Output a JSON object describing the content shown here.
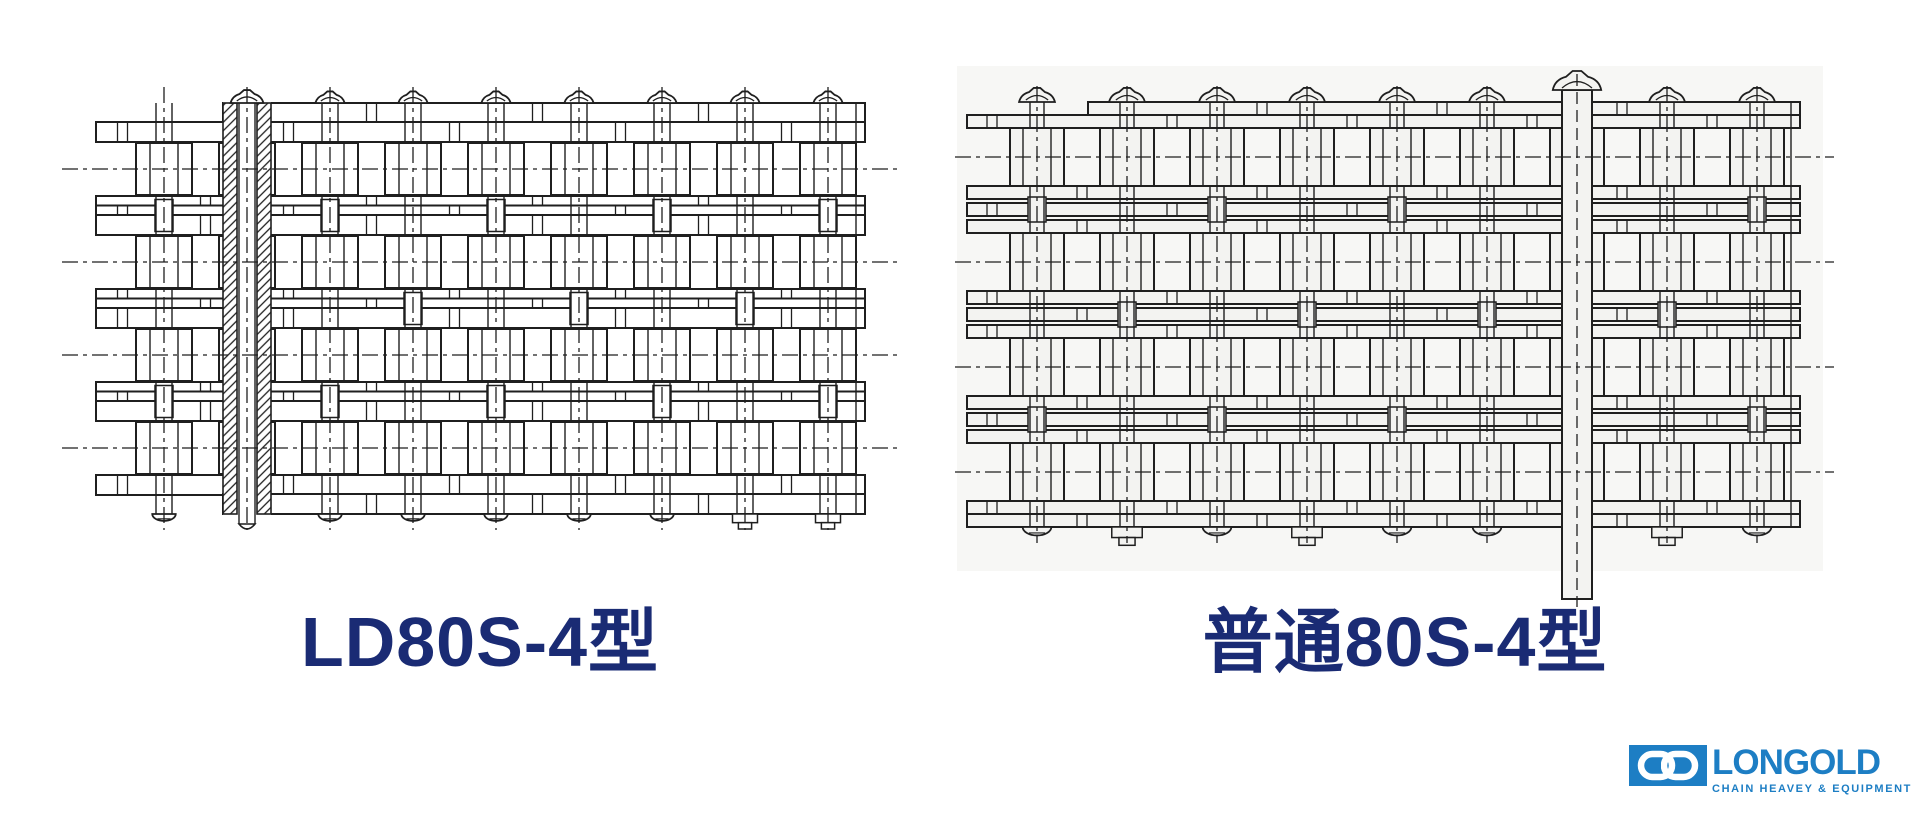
{
  "page": {
    "background_color": "#ffffff"
  },
  "drawings": {
    "left": {
      "label": "LD80S-4型"
    },
    "right": {
      "label": "普通80S-4型"
    }
  },
  "style": {
    "label_color": "#1a2b74",
    "line_color": "#1f1f1f",
    "right_drawing_fill": "#f3f3f1",
    "right_drawing_backdrop": "#f7f7f5",
    "logo_color": "#1d7ec4"
  },
  "logo": {
    "brand": "LONGOLD",
    "tagline": "CHAIN HEAVEY & EQUIPMENT",
    "icon": "gd-chain-link-icon"
  }
}
